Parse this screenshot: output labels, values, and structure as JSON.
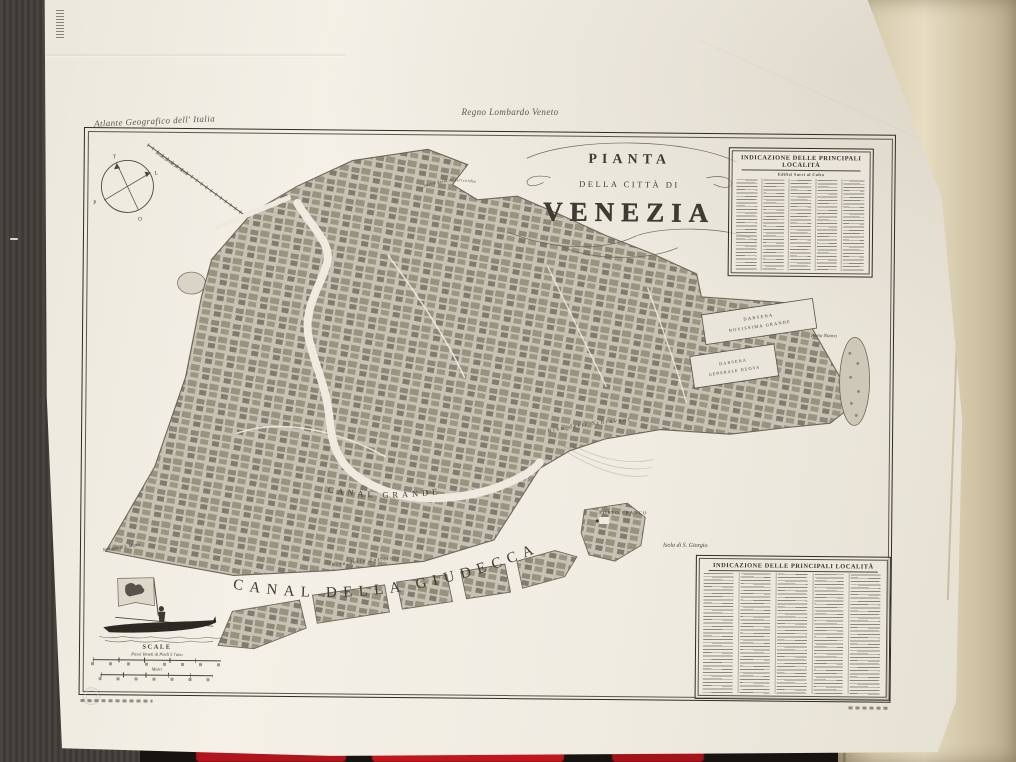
{
  "photo": {
    "surface_color": "#423e3a",
    "under_sheet_color": "#d8ccae",
    "red_accent_color": "#bf1620"
  },
  "sheet": {
    "series_title": "Atlante Geografico dell' Italia",
    "region_header": "Regno Lombardo Veneto"
  },
  "map": {
    "title": {
      "line1": "PIANTA",
      "line2": "DELLA CITTÀ DI",
      "line3": "VENEZIA"
    },
    "labels": {
      "canal_grande": "CANAL GRANDE",
      "canal_della_giudecca": "CANAL DELLA GIUDECCA",
      "riva_delle_zattere": "Riva delle Zattere",
      "riva_delli_schiavoni": "Riva delli Schiavoni",
      "darsena_grande_1": "DARSENA",
      "darsena_grande_2": "NOVISSIMA GRANDE",
      "darsena_nuova_1": "DARSENA",
      "darsena_nuova_2": "GENERALE NUOVA",
      "porto_nuovo": "Porto Nuovo",
      "porto_franco": "PORTO FRANCO",
      "isola_s_giorgio": "Isola di S. Giorgio",
      "spiaggia_s_marta": "Spiaggia di S. Marta",
      "sacca_misericordia": "Sacca della Misericordia",
      "strada_ferrata": "Strada ferrata per Mestre"
    },
    "compass": {
      "n": "T",
      "e": "L",
      "s": "O",
      "w": "P"
    },
    "scale": {
      "heading": "SCALE",
      "bar1_caption": "Passi Veneti di Piedi 5 l'uno",
      "bar2_caption": "Metri"
    },
    "legend_top": {
      "header": "INDICAZIONE DELLE PRINCIPALI LOCALITÀ",
      "subheader": "Edifizi Sacri al Culto"
    },
    "legend_bottom": {
      "header": "INDICAZIONE DELLE PRINCIPALI LOCALITÀ"
    }
  }
}
